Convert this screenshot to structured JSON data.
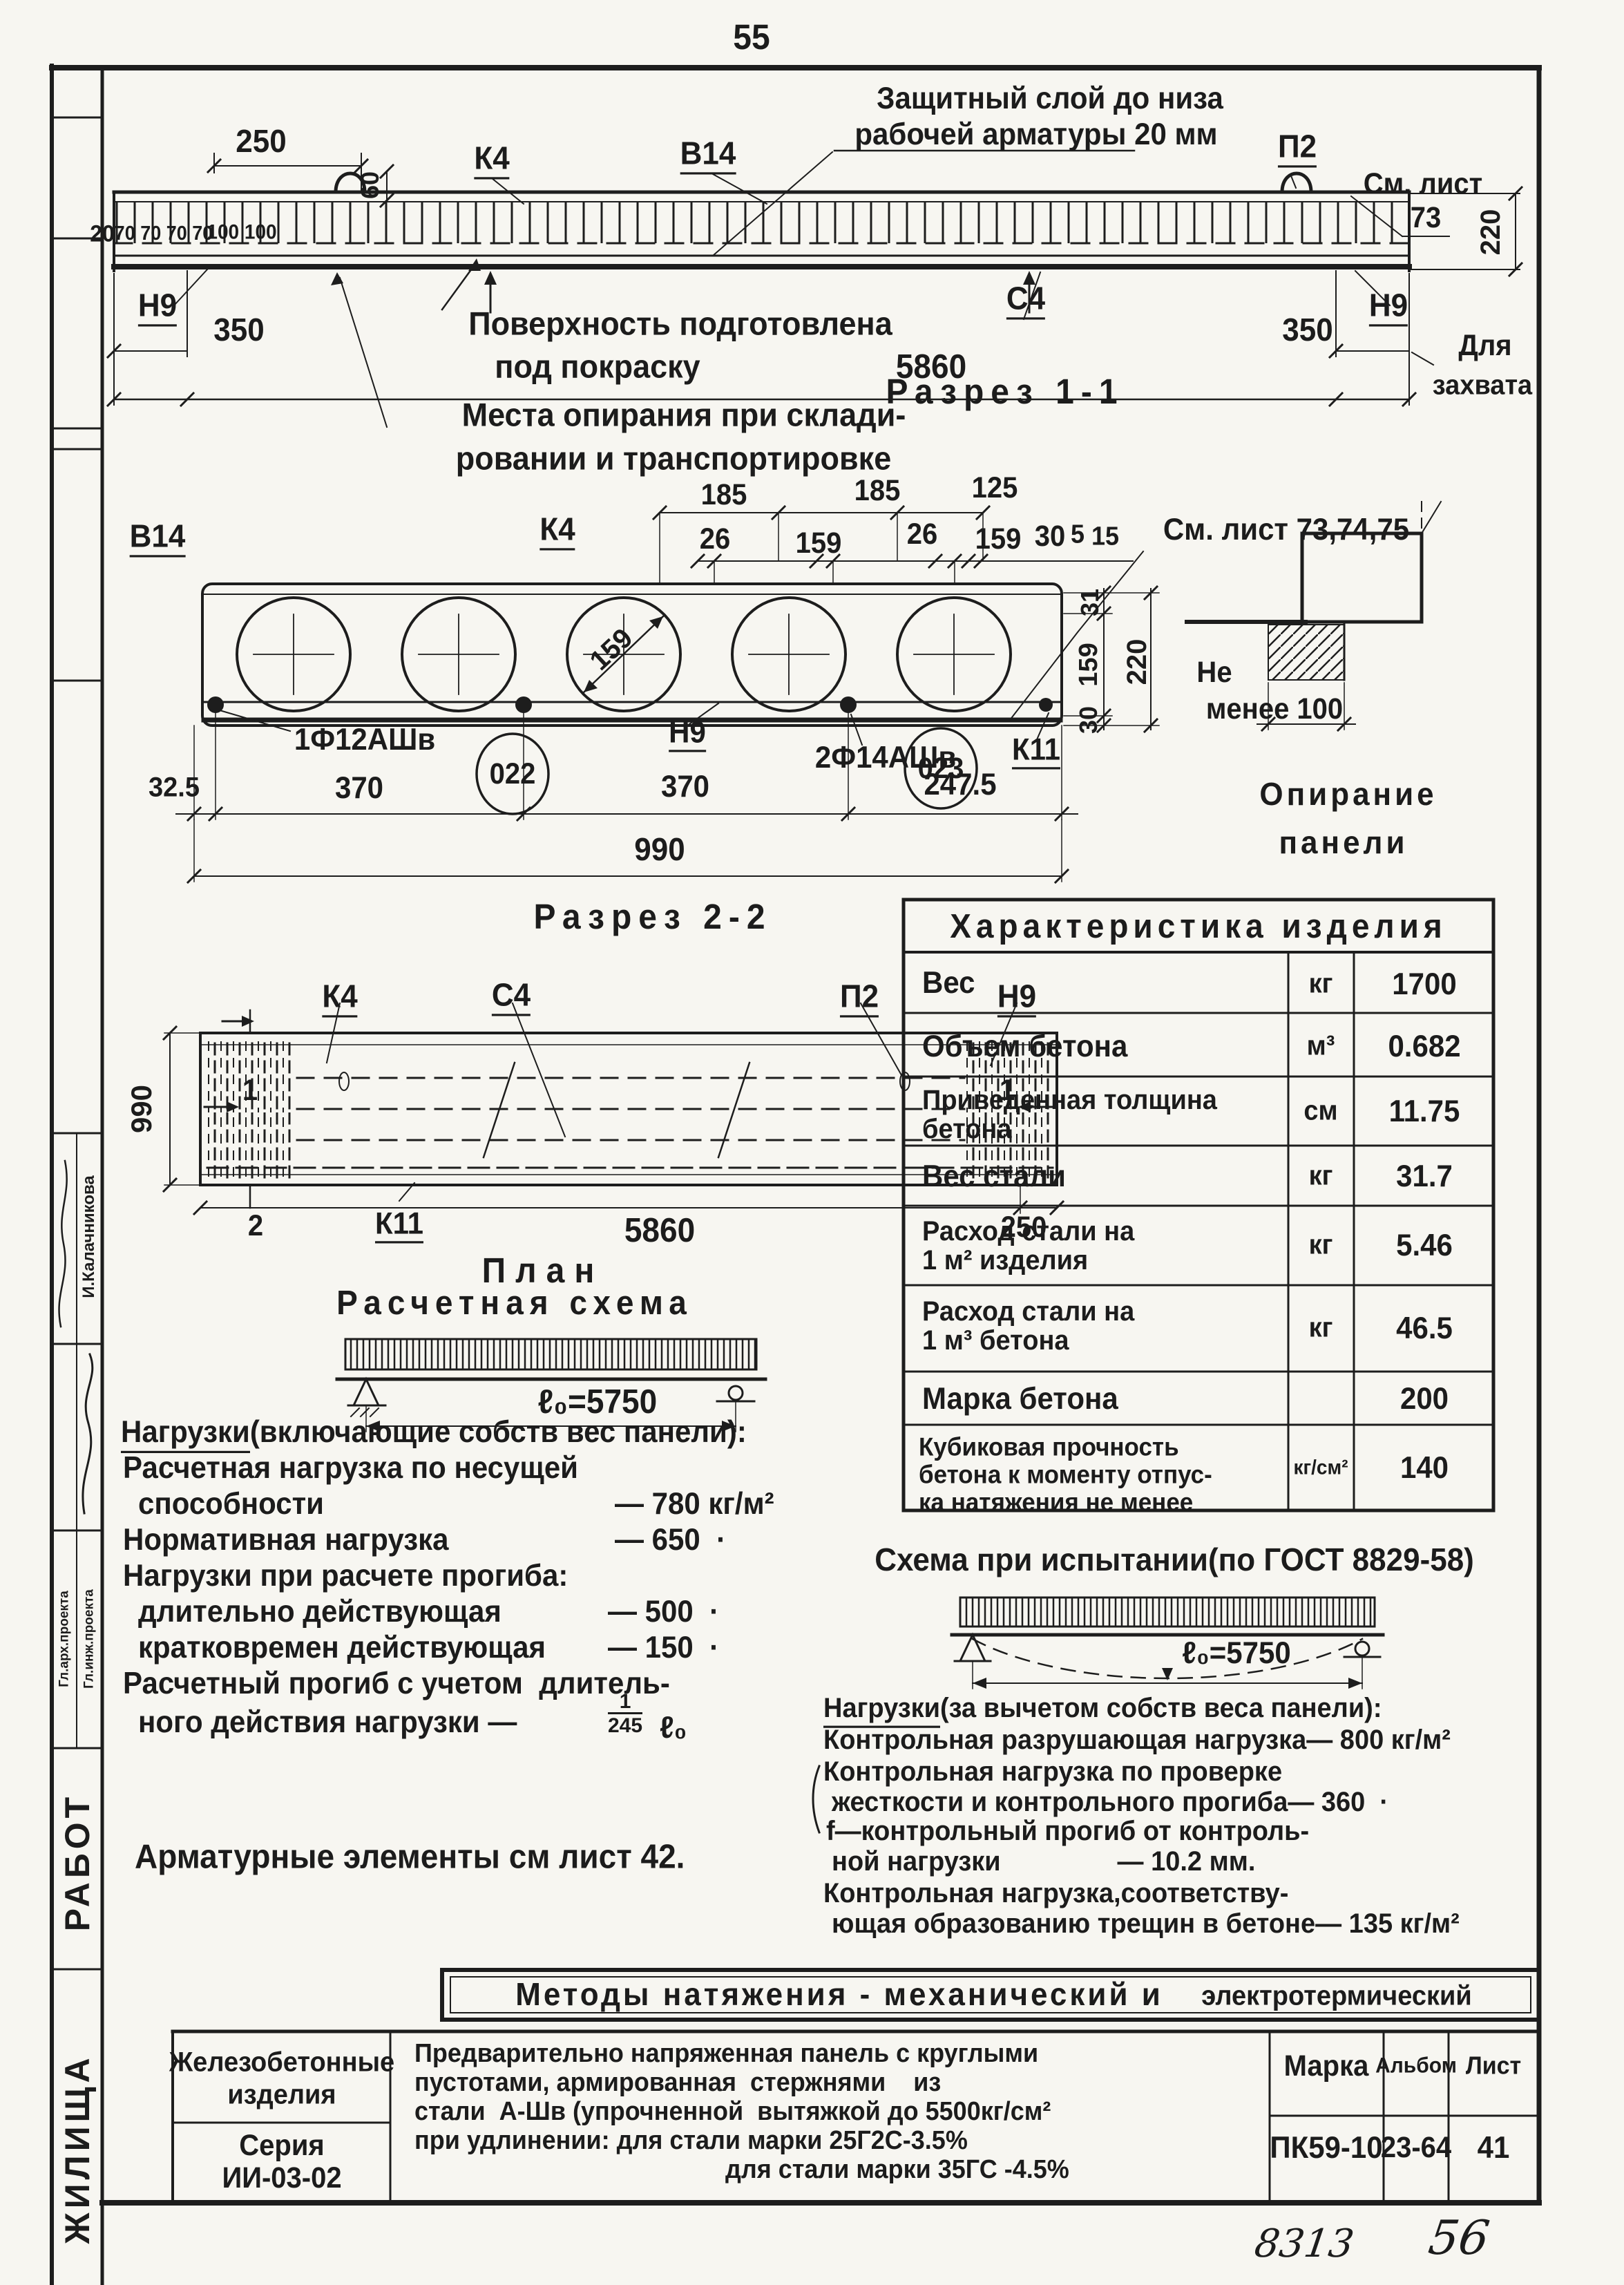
{
  "page": {
    "sheet": "55",
    "hw1": "8313",
    "hw2": "56"
  },
  "elev": {
    "callout1": "Защитный слой до низа",
    "callout2": "рабочей арматуры 20 мм",
    "d250": "250",
    "k4": "К4",
    "v14": "В14",
    "p2": "П2",
    "see1": "См. лист",
    "see1b": "73",
    "d60": "60",
    "d20": "20",
    "d70": "70 70 70 70",
    "d100": "100 100",
    "n9l": "Н9",
    "d350l": "350",
    "surf1": "Поверхность подготовлена",
    "surf2": "под покраску",
    "d5860": "5860",
    "c4": "С4",
    "d350r": "350",
    "n9r": "Н9",
    "grip1": "Для",
    "grip2": "захвата",
    "d220": "220",
    "stor1": "Места опирания при склади-",
    "stor2": "ровании и транспортировке",
    "cap": "Разрез 1-1"
  },
  "sec": {
    "v14": "В14",
    "k4": "К4",
    "d185a": "185",
    "d185b": "185",
    "d125": "125",
    "d26a": "26",
    "d159a": "159",
    "d26b": "26",
    "d159b": "159",
    "d30": "30",
    "d5": "5",
    "d15": "15",
    "see": "См. лист 73,74,75",
    "dia159": "159",
    "r31": "31",
    "r159": "159",
    "r220": "220",
    "r30": "30",
    "k11": "К11",
    "bar1": "1Ф12АШв",
    "b022": "022",
    "n9": "Н9",
    "bar2": "2Ф14АШв",
    "b023": "023",
    "d325": "32.5",
    "d370a": "370",
    "d370b": "370",
    "d2475": "247.5",
    "d990": "990",
    "cap": "Разрез 2-2"
  },
  "bear": {
    "l1": "Не",
    "l2": "менее 100",
    "c1": "Опирание",
    "c2": "панели"
  },
  "plan": {
    "k4": "К4",
    "c4": "С4",
    "p2": "П2",
    "n9": "Н9",
    "s1a": "1",
    "s1b": "1",
    "s2": "2",
    "d990": "990",
    "k11": "К11",
    "d5860": "5860",
    "d250": "250",
    "cap": "План"
  },
  "calc": {
    "title": "Расчетная схема",
    "span": "ℓ₀=5750",
    "l1a": "Нагрузки",
    "l1b": "(включающие собств вес панели):",
    "l2": "Расчетная нагрузка по несущей",
    "l3a": "способности",
    "l3b": "— 780 кг/м²",
    "l4a": "Нормативная нагрузка",
    "l4b": "— 650  ·",
    "l5": "Нагрузки при расчете прогиба:",
    "l6a": "длительно действующая",
    "l6b": "— 500  ·",
    "l7a": "кратковремен действующая",
    "l7b": "— 150  ·",
    "l8": "Расчетный прогиб с учетом  длитель-",
    "l9": "ного действия нагрузки —",
    "fn": "1",
    "fd": "245",
    "ft": "ℓ₀",
    "note": "Арматурные элементы см лист 42."
  },
  "test": {
    "title": "Схема при испытании(по ГОСТ 8829-58)",
    "span": "ℓ₀=5750",
    "l1a": "Нагрузки",
    "l1b": "(за вычетом собств веса панели):",
    "l2": "Контрольная разрушающая нагрузка— 800 кг/м²",
    "l3": "Контрольная нагрузка по проверке",
    "l4": "жесткости и контрольного прогиба— 360  ·",
    "l5": "f—контрольный прогиб от контроль-",
    "l6": "ной нагрузки                — 10.2 мм.",
    "l7": "Контрольная нагрузка,соответству-",
    "l8": "ющая образованию трещин в бетоне— 135 кг/м²"
  },
  "table": {
    "title": "Характеристика изделия",
    "rows": [
      {
        "n1": "Вес",
        "unit": "кг",
        "val": "1700"
      },
      {
        "n1": "Объем бетона",
        "unit": "м³",
        "val": "0.682"
      },
      {
        "n1": "Приведенная толщина",
        "n2": "бетона",
        "unit": "см",
        "val": "11.75"
      },
      {
        "n1": "Вес стали",
        "unit": "кг",
        "val": "31.7"
      },
      {
        "n1": "Расход стали на",
        "n2": "1 м² изделия",
        "unit": "кг",
        "val": "5.46"
      },
      {
        "n1": "Расход стали на",
        "n2": "1 м³ бетона",
        "unit": "кг",
        "val": "46.5"
      },
      {
        "n1": "Марка бетона",
        "unit": "",
        "val": "200"
      },
      {
        "n1": "Кубиковая прочность",
        "n2": "бетона к моменту отпус-",
        "n3": "ка натяжения не менее",
        "unit": "кг/см²",
        "val": "140"
      }
    ]
  },
  "banner": {
    "t1": "Методы натяжения - механический и",
    "t2": "электротермический"
  },
  "tb": {
    "type1": "Железобетонные",
    "type2": "изделия",
    "series_l": "Серия",
    "series_v": "ИИ-03-02",
    "d1": "Предварительно напряженная панель с круглыми",
    "d2": "пустотами, армированная  стержнями    из",
    "d3": "стали  А-Шв (упрочненной  вытяжкой до 5500кг/см²",
    "d4": "при удлинении: для стали марки 25Г2С-3.5%",
    "d5": "для стали марки 35ГС -4.5%",
    "marka_l": "Марка",
    "marka_v": "ПК59-10",
    "album_l": "Альбом",
    "album_v": "23-64",
    "list_l": "Лист",
    "list_v": "41"
  },
  "stamp": {
    "name": "И.Калачникова",
    "role1": "Гл.инж.проекта",
    "role2": "Гл.арх.проекта",
    "w1": "РАБОТ",
    "w2": "ЖИЛИЩА"
  }
}
